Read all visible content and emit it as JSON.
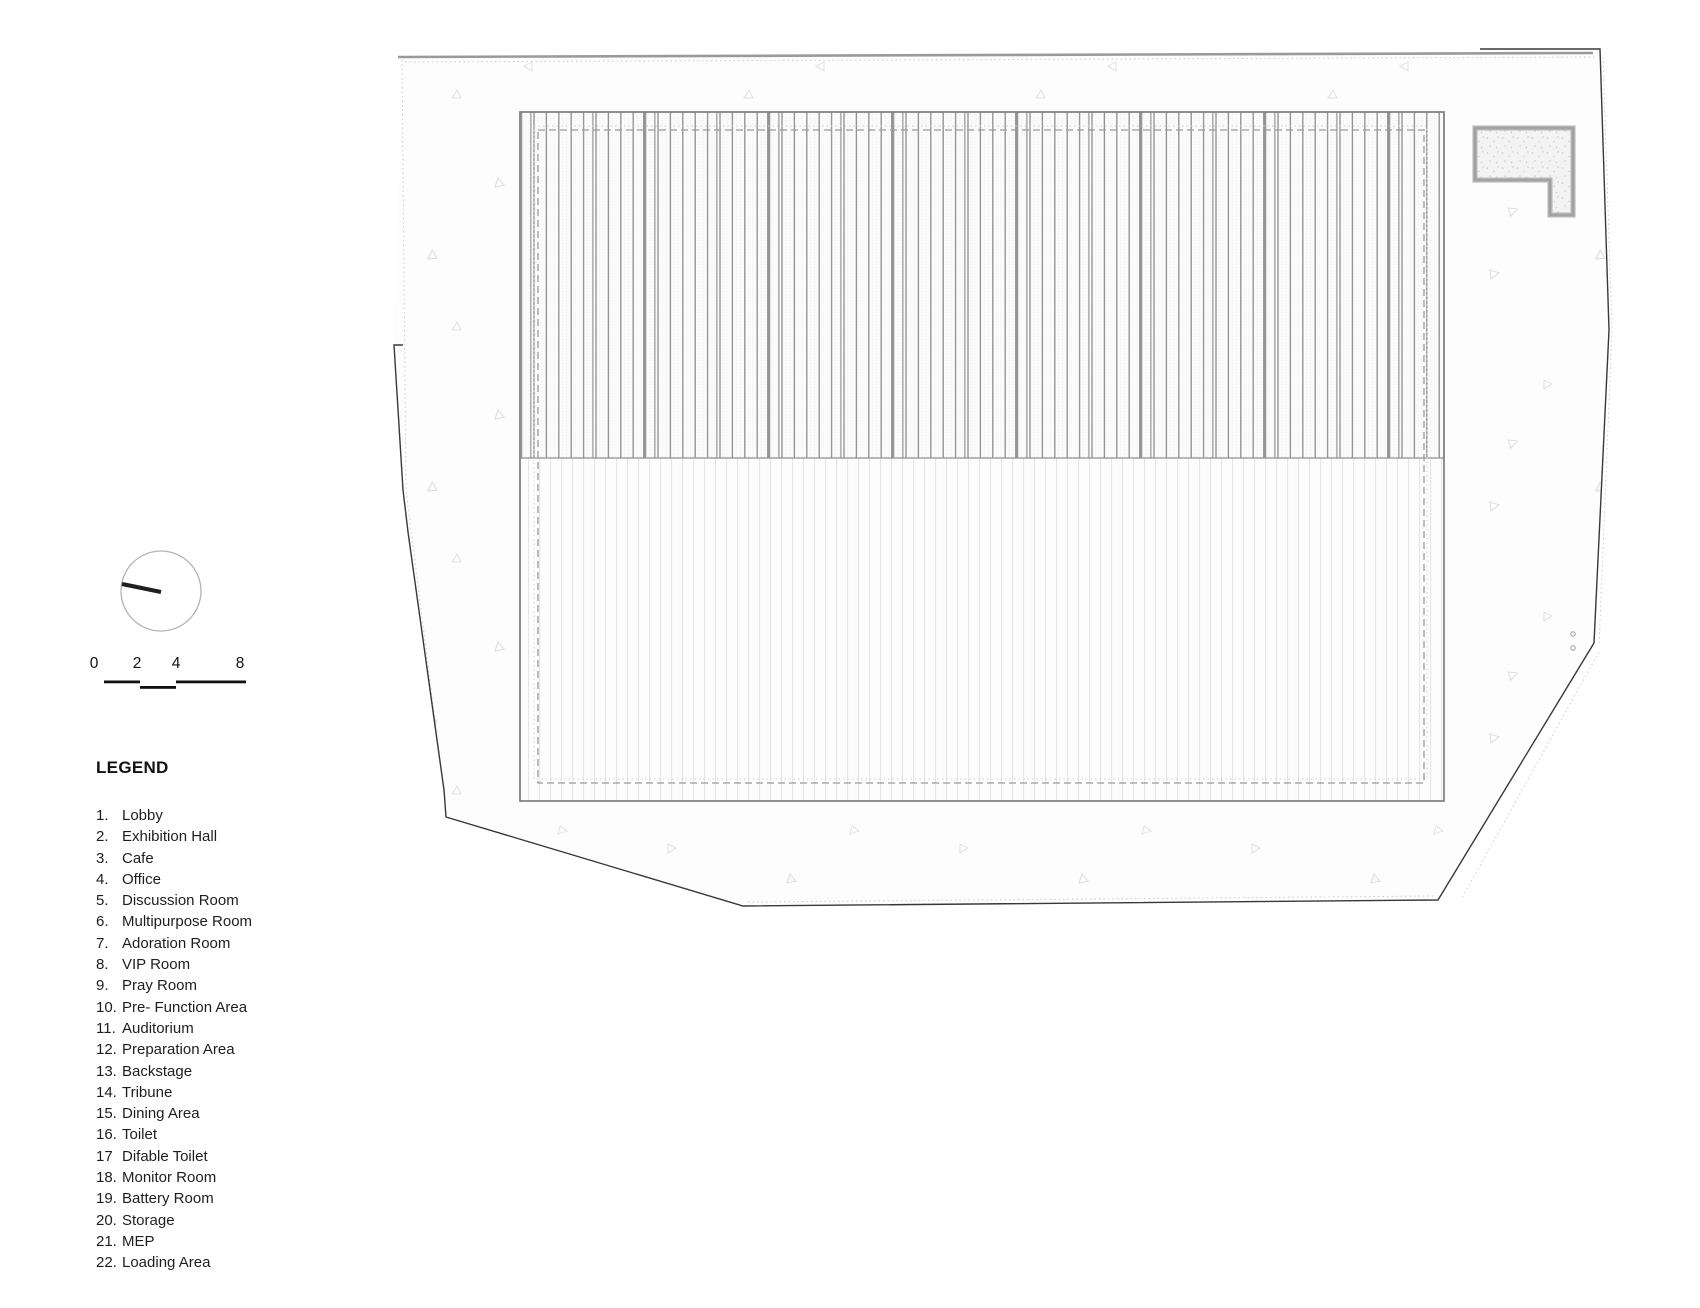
{
  "drawing": {
    "type": "architectural-site-plan",
    "colors": {
      "background": "#ffffff",
      "site_fill": "#fdfdfd",
      "site_boundary_dark": "#383838",
      "site_boundary_gray": "#9a9a9a",
      "site_offset_dotted": "#c9c9c9",
      "building_outline": "#7d7d7d",
      "roof_hatch_line": "#8d8d8d",
      "roof_joint_line": "#7a7a7a",
      "floor_hatch_line": "#e4e4e4",
      "inner_dashed_line": "#9a9a9a",
      "annex_wall": "#b4b4b4",
      "vegetation_marker": "#e1e1e1",
      "north_needle": "#1f1f1f",
      "scale_bar": "#111111",
      "legend_text": "#1e1e1e"
    }
  },
  "scale_bar": {
    "labels": [
      "0",
      "2",
      "4",
      "8"
    ]
  },
  "legend": {
    "title": "LEGEND",
    "items": [
      {
        "num": "1.",
        "label": "Lobby"
      },
      {
        "num": "2.",
        "label": "Exhibition Hall"
      },
      {
        "num": "3.",
        "label": "Cafe"
      },
      {
        "num": "4.",
        "label": "Office"
      },
      {
        "num": "5.",
        "label": "Discussion Room"
      },
      {
        "num": "6.",
        "label": "Multipurpose Room"
      },
      {
        "num": "7.",
        "label": "Adoration Room"
      },
      {
        "num": "8.",
        "label": "VIP Room"
      },
      {
        "num": "9.",
        "label": "Pray Room"
      },
      {
        "num": "10.",
        "label": "Pre- Function Area"
      },
      {
        "num": "11.",
        "label": "Auditorium"
      },
      {
        "num": "12.",
        "label": "Preparation Area"
      },
      {
        "num": "13.",
        "label": "Backstage"
      },
      {
        "num": "14.",
        "label": "Tribune"
      },
      {
        "num": "15.",
        "label": "Dining Area"
      },
      {
        "num": "16.",
        "label": "Toilet"
      },
      {
        "num": "17",
        "label": "Difable Toilet"
      },
      {
        "num": "18.",
        "label": "Monitor Room"
      },
      {
        "num": "19.",
        "label": "Battery Room"
      },
      {
        "num": "20.",
        "label": "Storage"
      },
      {
        "num": "21.",
        "label": "MEP"
      },
      {
        "num": "22.",
        "label": "Loading Area"
      }
    ]
  }
}
